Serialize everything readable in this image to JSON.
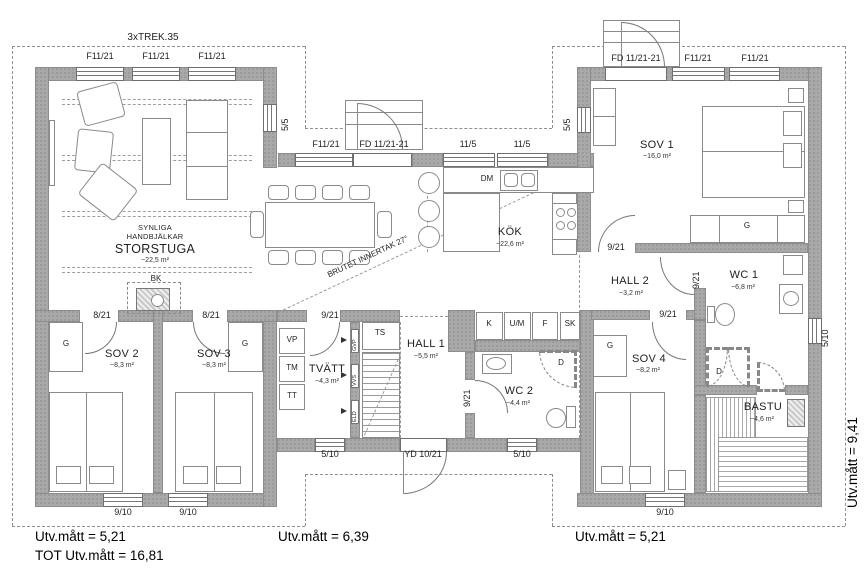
{
  "annotations": {
    "top_note": "3xTREK.35",
    "ceiling_note": "BRUTET INNERTAK 27°",
    "utv_left": "Utv.mått = 5,21",
    "utv_left_total": "TOT Utv.mått = 16,81",
    "utv_middle": "Utv.mått = 6,39",
    "utv_right": "Utv.mått = 5,21",
    "utv_side": "Utv.mått = 9,41"
  },
  "rooms": {
    "storstuga": {
      "note_line1": "SYNLIGA",
      "note_line2": "HANDBJÄLKAR",
      "name": "STORSTUGA",
      "area": "~22,5 m²"
    },
    "kok": {
      "name": "KÖK",
      "area": "~22,6 m²"
    },
    "sov1": {
      "name": "SOV 1",
      "area": "~16,0 m²"
    },
    "sov2": {
      "name": "SOV 2",
      "area": "~8,3 m²"
    },
    "sov3": {
      "name": "SOV 3",
      "area": "~8,3 m²"
    },
    "sov4": {
      "name": "SOV 4",
      "area": "~8,2 m²"
    },
    "hall1": {
      "name": "HALL 1",
      "area": "~5,5 m²"
    },
    "hall2": {
      "name": "HALL 2",
      "area": "~3,2 m²"
    },
    "wc1": {
      "name": "WC 1",
      "area": "~6,8 m²"
    },
    "wc2": {
      "name": "WC 2",
      "area": "~4,4 m²"
    },
    "tvatt": {
      "name": "TVÄTT",
      "area": "~4,3 m²"
    },
    "bastu": {
      "name": "BASTU",
      "area": "~4,6 m²"
    }
  },
  "openings": {
    "f1121": "F11/21",
    "fd112121": "FD 11/21-21",
    "w115": "11/5",
    "w55": "5/5",
    "w510": "5/10",
    "w910": "9/10",
    "w821": "8/21",
    "w921": "9/21",
    "yd1021": "YD 10/21"
  },
  "fixtures": {
    "bk": "BK",
    "dm": "DM",
    "ts": "TS",
    "vp": "VP",
    "tm": "TM",
    "tt": "TT",
    "k": "K",
    "um": "U/M",
    "f": "F",
    "sk": "SK",
    "d": "D",
    "g": "G",
    "gvp": "GVP",
    "vvs": "VVS",
    "eld": "ELD"
  },
  "colors": {
    "wall": "#a9a9a9",
    "line": "#777777",
    "text": "#1f1f1f"
  }
}
